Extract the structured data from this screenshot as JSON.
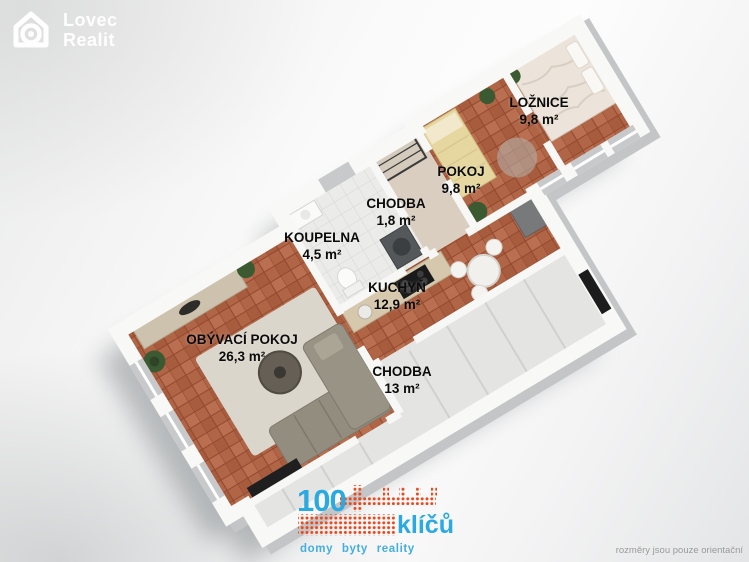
{
  "watermark": {
    "line1": "Lovec",
    "line2": "Realit",
    "icon": "house-outline-icon"
  },
  "rooms": [
    {
      "name": "LOŽNICE",
      "area": "9,8 m²"
    },
    {
      "name": "POKOJ",
      "area": "9,8 m²"
    },
    {
      "name": "CHODBA",
      "area": "1,8 m²"
    },
    {
      "name": "KOUPELNA",
      "area": "4,5 m²"
    },
    {
      "name": "KUCHYŇ",
      "area": "12,9 m²"
    },
    {
      "name": "OBÝVACÍ POKOJ",
      "area": "26,3 m²"
    },
    {
      "name": "CHODBA",
      "area": "13 m²"
    }
  ],
  "brand": {
    "number": "100",
    "name": "klíčů",
    "tagline": "domy byty reality",
    "icon": "dotted-key-icon",
    "blue": "#2ba9e1",
    "red": "#e8481c"
  },
  "disclaimer": "rozměry jsou pouze orientační",
  "colors": {
    "floor_terracotta": "#b06547",
    "floor_bathroom": "#ebebe9",
    "floor_corridor": "#e4e4e2",
    "walls": "#f7f7f6"
  }
}
